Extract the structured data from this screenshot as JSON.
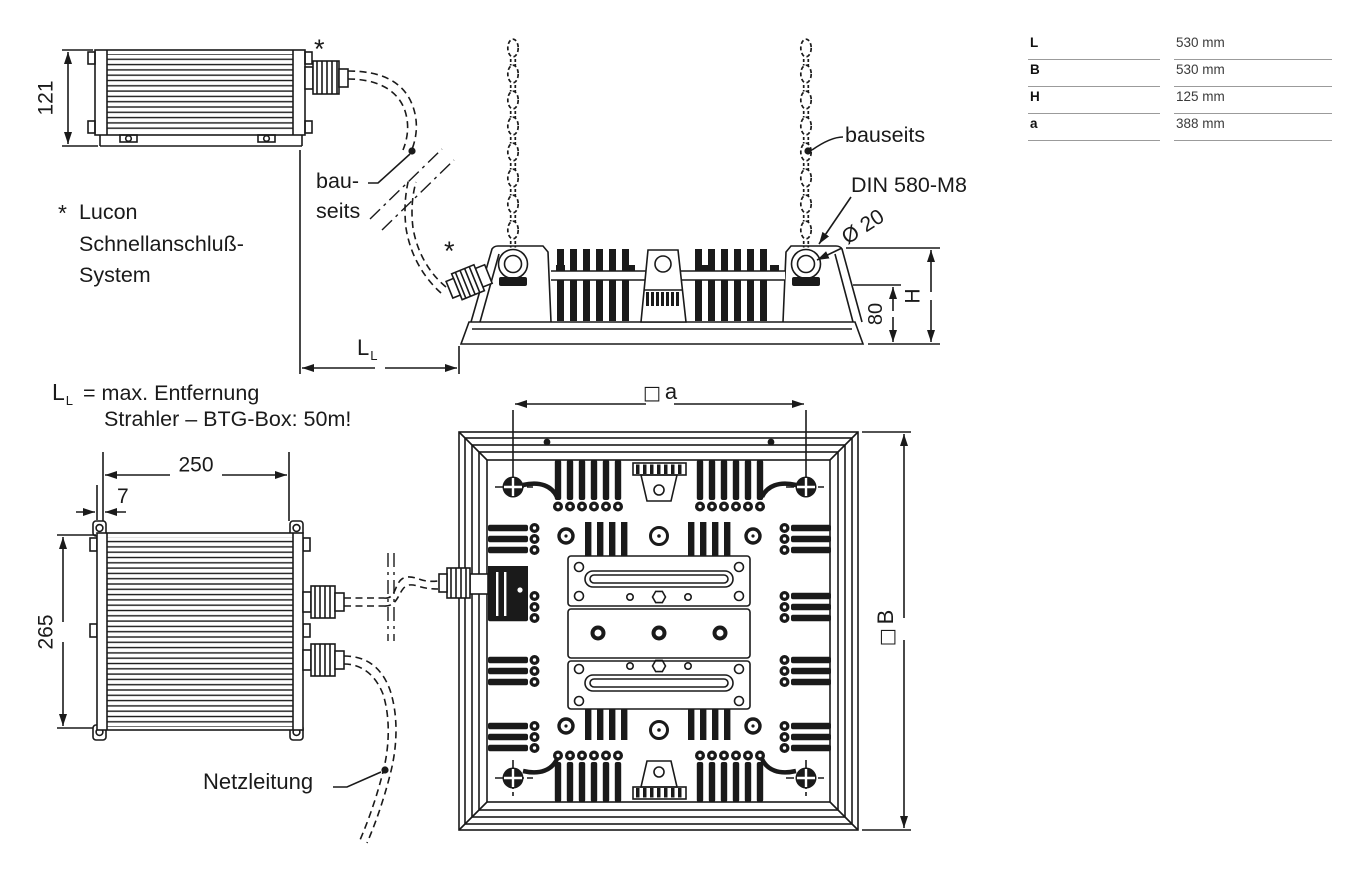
{
  "colors": {
    "ink": "#1a1a1a",
    "table_rule": "#9b9b9b",
    "background": "#ffffff"
  },
  "dimension_table": {
    "rows": [
      {
        "label": "L",
        "value": "530 mm"
      },
      {
        "label": "B",
        "value": "530 mm"
      },
      {
        "label": "H",
        "value": "125 mm"
      },
      {
        "label": "a",
        "value": "388 mm"
      }
    ]
  },
  "btg_box_side_view": {
    "height_dim": "121",
    "connector_mark": "*"
  },
  "btg_box_front_view": {
    "width_dim": "250",
    "flange_dim": "7",
    "height_dim": "265",
    "mains_cable_label": "Netzleitung"
  },
  "luminaire_side_view": {
    "connector_mark": "*",
    "chain_label_left_line1": "bau-",
    "chain_label_left_line2": "seits",
    "chain_label_right": "bauseits",
    "eyebolt_label": "DIN 580-M8",
    "ring_diameter": "Ø 20",
    "upper_height_dim": "80",
    "total_height_dim": "H"
  },
  "luminaire_top_view": {
    "spacing_symbol": "□",
    "spacing_letter": "a",
    "width_symbol": "□",
    "width_letter": "B"
  },
  "cable_length_dim": {
    "main": "L",
    "sub": "L"
  },
  "notes": {
    "lucon": {
      "mark": "*",
      "line1": "Lucon",
      "line2": "Schnellanschluß-",
      "line3": "System"
    },
    "cable_note": {
      "symbol_main": "L",
      "symbol_sub": "L",
      "line1_rest": "= max. Entfernung",
      "line2": "Strahler – BTG-Box: 50m!"
    }
  }
}
